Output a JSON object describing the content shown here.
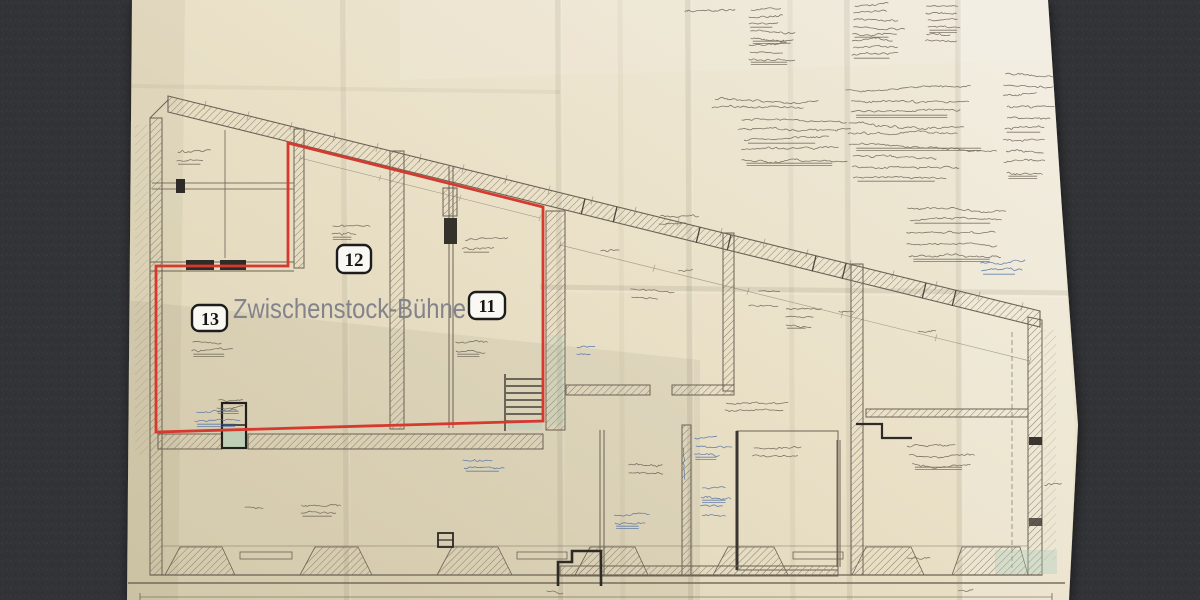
{
  "photo": {
    "background_color": "#323336",
    "paper_color": "#e9e0c6"
  },
  "plan": {
    "overlay_title": "Zwischenstock-Bühne",
    "overlay_title_color": "#83838b",
    "marked_area": {
      "outline_color": "#d6392e",
      "labels": [
        {
          "text": "12"
        },
        {
          "text": "13"
        },
        {
          "text": "11"
        }
      ]
    },
    "ink_colors": {
      "pencil": "#6b6355",
      "blue_pen": "#4a6fa5",
      "label_border": "#1c1c1c"
    }
  }
}
